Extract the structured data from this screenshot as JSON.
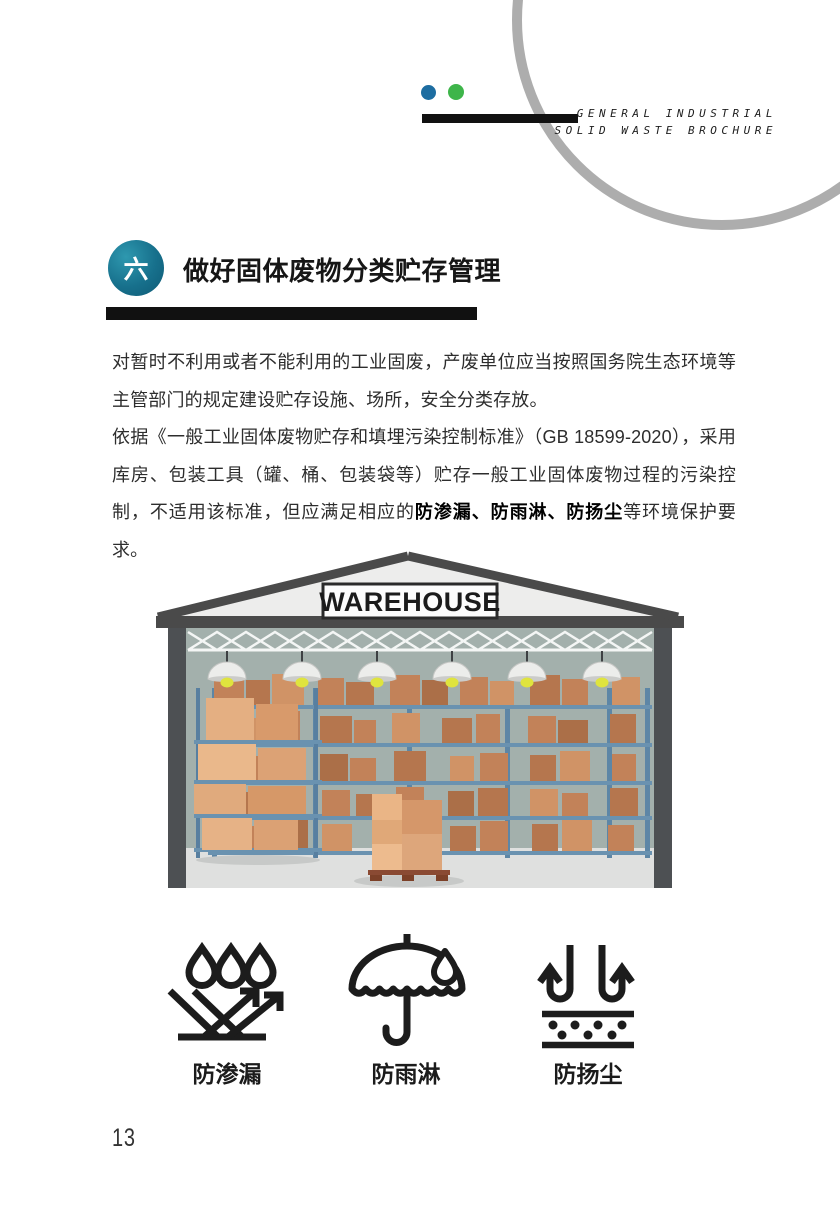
{
  "header": {
    "brand_line1": "GENERAL INDUSTRIAL",
    "brand_line2": "SOLID WASTE BROCHURE",
    "dot_blue_color": "#1d6da1",
    "dot_green_color": "#3eb54a",
    "circle_color": "#adadad",
    "accent_bar_color": "#111111"
  },
  "section": {
    "badge_number": "六",
    "badge_color": "#17708c",
    "title": "做好固体废物分类贮存管理",
    "underline_color": "#111111"
  },
  "body": {
    "paragraph1": "对暂时不利用或者不能利用的工业固废，产废单位应当按照国务院生态环境等主管部门的规定建设贮存设施、场所，安全分类存放。",
    "paragraph2_pre": "依据《一般工业固体废物贮存和填埋污染控制标准》（GB 18599-2020），采用库房、包装工具（罐、桶、包装袋等）贮存一般工业固体废物过程的污染控制，不适用该标准，但应满足相应的",
    "paragraph2_bold": "防渗漏、防雨淋、防扬尘",
    "paragraph2_post": "等环境保护要求。"
  },
  "illustration": {
    "sign_text": "WAREHOUSE",
    "wall_color": "#a3b0ac",
    "roof_color": "#ededec",
    "frame_color": "#4a4a4a",
    "floor_color": "#dfe0df",
    "rack_color": "#5d86a6",
    "box_color": "#c28259"
  },
  "features": [
    {
      "icon": "anti-seepage-icon",
      "label": "防渗漏"
    },
    {
      "icon": "anti-rain-icon",
      "label": "防雨淋"
    },
    {
      "icon": "anti-dust-icon",
      "label": "防扬尘"
    }
  ],
  "page": {
    "number": "13"
  }
}
